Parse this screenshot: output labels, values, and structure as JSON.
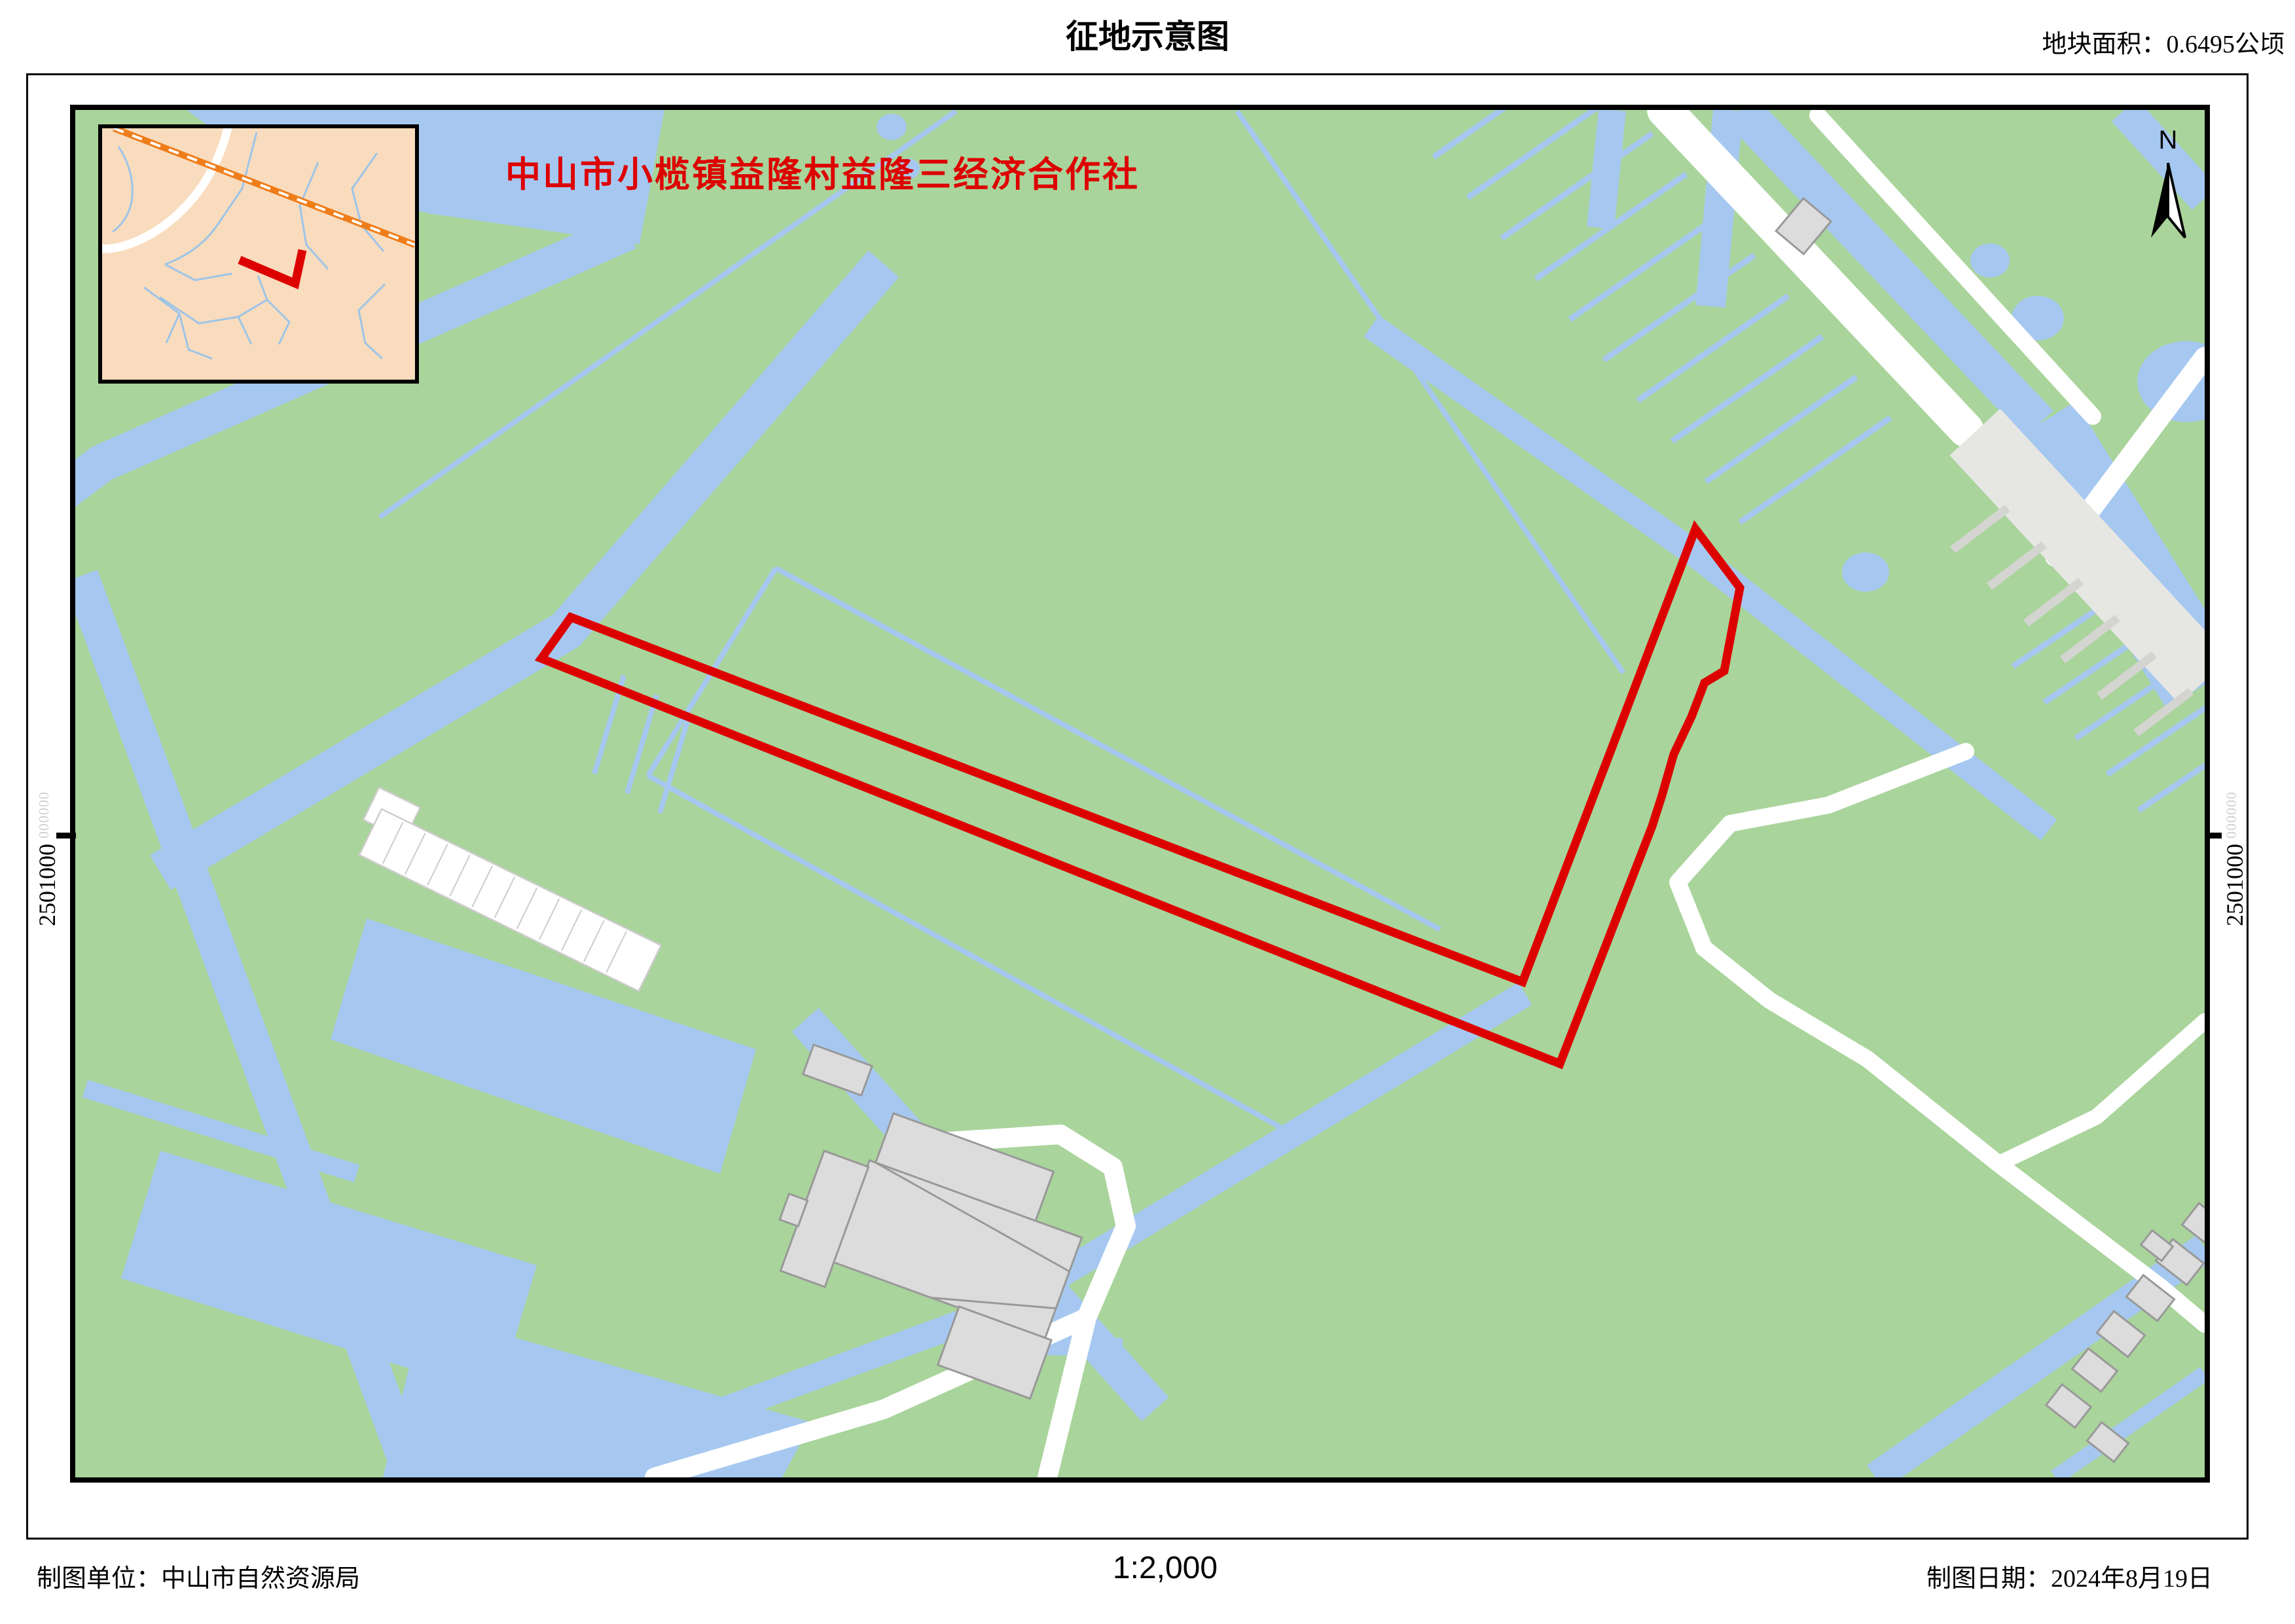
{
  "header": {
    "title": "征地示意图",
    "area_label": "地块面积：0.6495公顷"
  },
  "map": {
    "owner_label": "中山市小榄镇益隆村益隆三经济合作社",
    "north_label": "N",
    "grid_left": {
      "value": "2501000",
      "suffix": "000000"
    },
    "grid_right": {
      "value": "2501000",
      "suffix": "000000"
    },
    "parcel": {
      "outline_points": "757,775 2211,1332 2475,640 2543,730 2519,857 2489,875 2469,927 2442,984 2424,1047 2409,1094 2268,1457 712,838"
    },
    "inset": {
      "marker_points": "210,201 295,237 306,186"
    }
  },
  "footer": {
    "producer": "制图单位：中山市自然资源局",
    "scale": "1:2,000",
    "date": "制图日期：2024年8月19日"
  },
  "colors": {
    "land_green": "#a9d49b",
    "water_blue": "#a6c8f0",
    "inset_bg": "#f9dcbd",
    "railway_orange": "#ef7d1a",
    "building_gray": "#dcdcdc",
    "parcel_red": "#dd0000"
  }
}
